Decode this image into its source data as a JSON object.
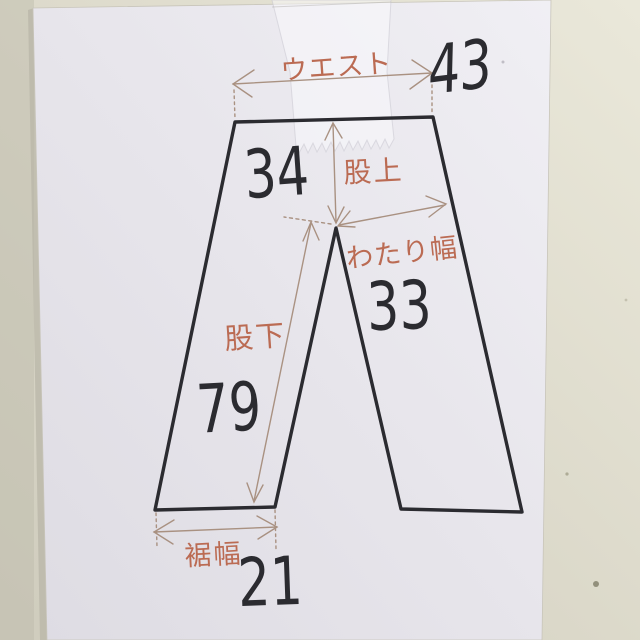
{
  "scene": {
    "description": "Photograph of a hand-drawn pants measurement diagram on white paper, taped to a desk",
    "colors": {
      "table": "#d9d6c7",
      "table_light": "#eae8da",
      "table_dark": "#c9c6b7",
      "paper": "#e6e4ea",
      "paper_light": "#f0eff4",
      "paper_shadow": "#b5b2a4",
      "ink_black": "#2b2b30",
      "label_orange": "#bb6b53",
      "guide_brown": "#a68d7c",
      "tape_white": "#ffffff"
    }
  },
  "diagram": {
    "type": "garment-measurement-sketch",
    "garment": "pants",
    "measurements": [
      {
        "id": "waist",
        "label": "ウエスト",
        "value": "43"
      },
      {
        "id": "rise",
        "label": "股上",
        "value": "34"
      },
      {
        "id": "thigh_width",
        "label": "わたり幅",
        "value": "33"
      },
      {
        "id": "inseam",
        "label": "股下",
        "value": "79"
      },
      {
        "id": "hem_width",
        "label": "裾幅",
        "value": "21"
      }
    ]
  }
}
